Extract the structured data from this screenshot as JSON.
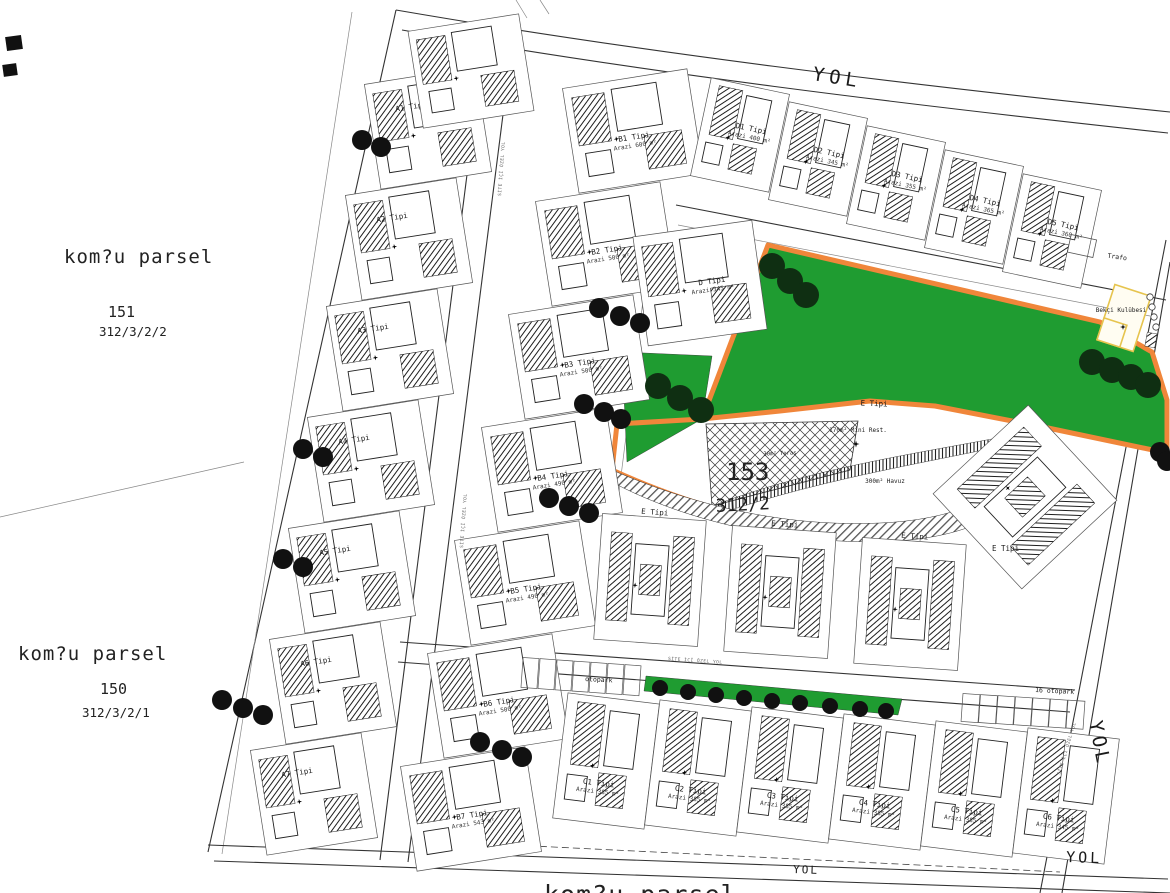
{
  "neighbors": {
    "p151": {
      "title": "kom?u parsel",
      "number": "151",
      "lot": "312/3/2/2"
    },
    "p150": {
      "title": "kom?u parsel",
      "number": "150",
      "lot": "312/3/2/1"
    },
    "bottom": {
      "title": "kom?u parsel"
    }
  },
  "main_parcel": {
    "number": "153",
    "lot": "312/2",
    "type_label": "E Tipi"
  },
  "roads": {
    "label": "YOL",
    "internal_label": "SİTE İÇİ ÖZEL YOL"
  },
  "amenities": {
    "trafo": "Trafo",
    "guard_house": "Bekçi Kulübesi",
    "mini_restaurant": "170m² Mini Rest.",
    "pool": "300m² Havuz",
    "terrace": "30m² Teras",
    "parking": "otopark",
    "parking_right": "16 otopark"
  },
  "villas": {
    "a": [
      {
        "label": "A1 Tipi"
      },
      {
        "label": "A2 Tipi"
      },
      {
        "label": "A3 Tipi"
      },
      {
        "label": "A4 Tipi"
      },
      {
        "label": "A5 Tipi"
      },
      {
        "label": "A6 Tipi"
      },
      {
        "label": "A7 Tipi"
      }
    ],
    "b": [
      {
        "label": "B1 Tipi",
        "area": "Arazi 600 m²"
      },
      {
        "label": "B2 Tipi",
        "area": "Arazi 500 m²"
      },
      {
        "label": "B3 Tipi",
        "area": "Arazi 500 m²"
      },
      {
        "label": "B4 Tipi",
        "area": "Arazi 490 m²"
      },
      {
        "label": "B5 Tipi",
        "area": "Arazi 490 m²"
      },
      {
        "label": "B6 Tipi",
        "area": "Arazi 500 m²"
      },
      {
        "label": "B7 Tipi",
        "area": "Arazi 543 m²"
      }
    ],
    "c": [
      {
        "label": "C1 Tipi",
        "area": "Arazi 385 m²"
      },
      {
        "label": "C2 Tipi",
        "area": "Arazi 385 m²"
      },
      {
        "label": "C3 Tipi",
        "area": "Arazi 385 m²"
      },
      {
        "label": "C4 Tipi",
        "area": "Arazi 385 m²"
      },
      {
        "label": "C5 Tipi",
        "area": "Arazi 385 m²"
      },
      {
        "label": "C6 Tipi",
        "area": "Arazi 345 m²"
      }
    ],
    "d": [
      {
        "label": "D1 Tipi",
        "area": "Arazi 400 m²"
      },
      {
        "label": "D2 Tipi",
        "area": "Arazi 345 m²"
      },
      {
        "label": "D3 Tipi",
        "area": "Arazi 355 m²"
      },
      {
        "label": "D4 Tipi",
        "area": "Arazi 365 m²"
      },
      {
        "label": "D5 Tipi",
        "area": "Arazi 360 m²"
      }
    ],
    "d_center": {
      "label": "D Tipi",
      "area": "Arazi 345 m²"
    },
    "e": [
      {
        "label": "E Tipi"
      },
      {
        "label": "E Tipi"
      },
      {
        "label": "E Tipi"
      },
      {
        "label": "E Tipi"
      }
    ]
  },
  "colors": {
    "park_green": "#1f9c31",
    "orange": "#f0863a",
    "yellow": "#e6c44e"
  }
}
